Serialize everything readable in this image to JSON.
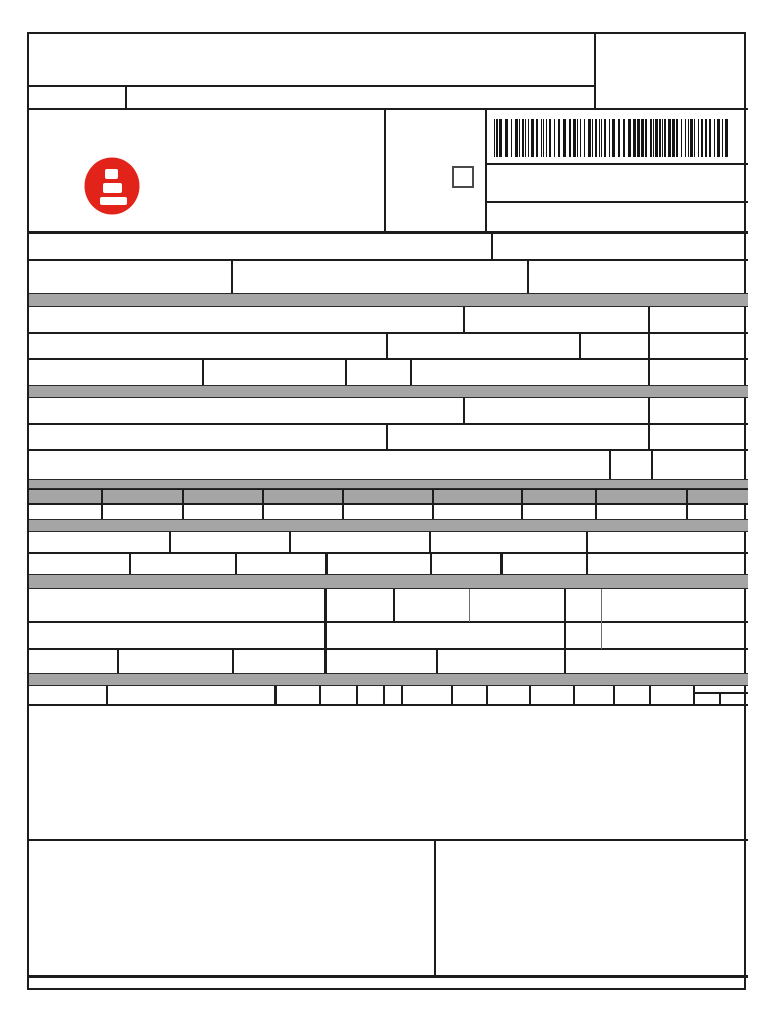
{
  "page": {
    "width_px": 768,
    "height_px": 1024,
    "background": "#ffffff"
  },
  "colors": {
    "border": "#1c1c1c",
    "band_grey": "#a5a5a5",
    "line_grey": "#6e6e6e",
    "logo_red": "#e2231a",
    "barcode_ink": "#141414"
  },
  "icons": {
    "brand_logo": "red-circle-with-three-white-bars-logo",
    "barcode": "code128-style-barcode",
    "checkbox": "empty-square-checkbox"
  },
  "checkbox": {
    "checked": false
  },
  "bands": [
    {
      "name": "recipient-sender-band",
      "label": ""
    },
    {
      "name": "invoice-bill-band",
      "label": ""
    },
    {
      "name": "tax-calculation-band",
      "label": ""
    },
    {
      "name": "tax-totals-band",
      "label": ""
    },
    {
      "name": "carrier-volumes-band",
      "label": ""
    },
    {
      "name": "items-band",
      "label": ""
    }
  ],
  "cells": {
    "all_values": "",
    "note": "every form cell on the page is blank"
  }
}
